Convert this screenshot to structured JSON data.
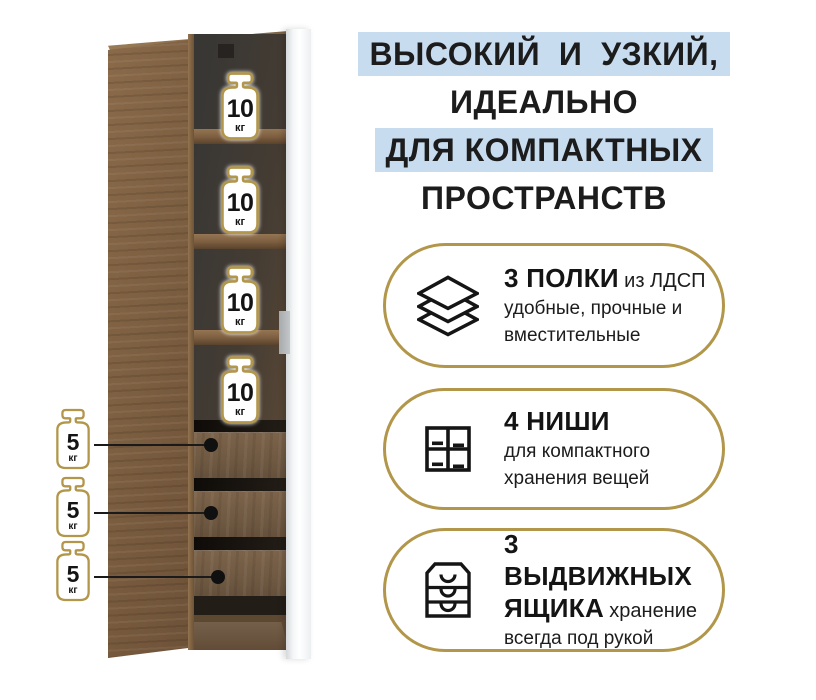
{
  "headline": {
    "lines": [
      {
        "text": "ВЫСОКИЙ  И  УЗКИЙ,",
        "highlighted": true
      },
      {
        "text": "ИДЕАЛЬНО",
        "highlighted": false
      },
      {
        "text": "ДЛЯ КОМПАКТНЫХ",
        "highlighted": true
      },
      {
        "text": "ПРОСТРАНСТВ",
        "highlighted": false
      }
    ]
  },
  "cabinet": {
    "shelf_badges": [
      {
        "value": "10",
        "unit": "кг"
      },
      {
        "value": "10",
        "unit": "кг"
      },
      {
        "value": "10",
        "unit": "кг"
      },
      {
        "value": "10",
        "unit": "кг"
      }
    ],
    "drawer_badges": [
      {
        "value": "5",
        "unit": "кг"
      },
      {
        "value": "5",
        "unit": "кг"
      },
      {
        "value": "5",
        "unit": "кг"
      }
    ]
  },
  "features": [
    {
      "icon": "shelves-layers-icon",
      "heading": "3 ПОЛКИ",
      "note": "из ЛДСП",
      "description": "удобные, прочные и вместительные"
    },
    {
      "icon": "niches-grid-icon",
      "heading": "4 НИШИ",
      "note": "",
      "description": "для компактного хранения вещей"
    },
    {
      "icon": "drawers-chest-icon",
      "heading": "3 ВЫДВИЖНЫХ ЯЩИКА",
      "note": "хранение",
      "description": "всегда под рукой"
    }
  ],
  "colors": {
    "accent_gold": "#b2964a",
    "highlight_blue": "#c8dcf0",
    "wood_brown": "#7b5d40",
    "ink": "#1a1a1a"
  }
}
